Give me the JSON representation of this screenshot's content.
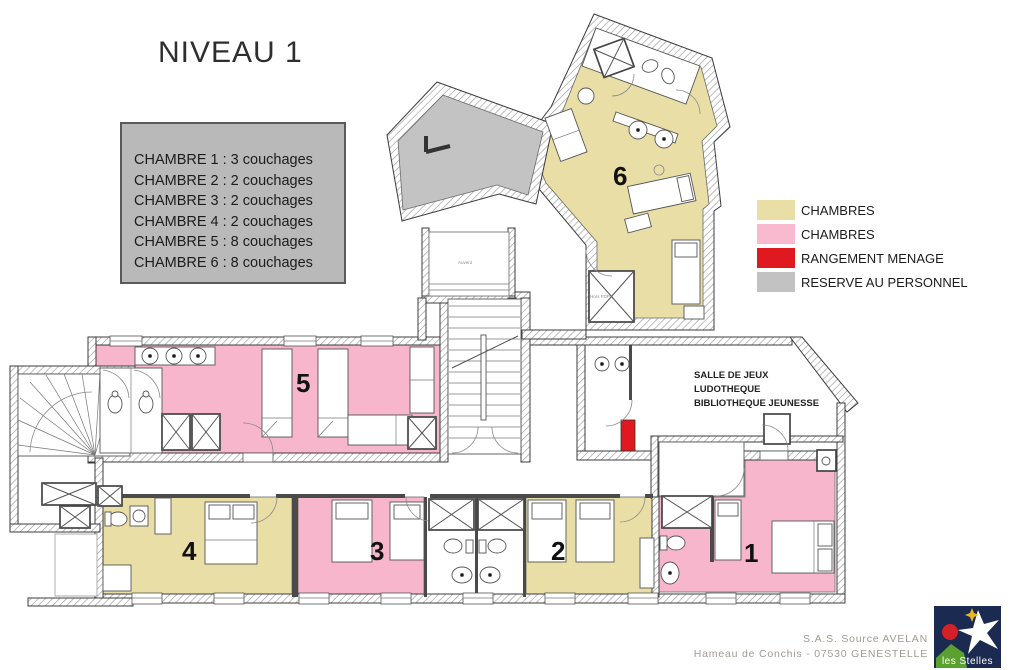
{
  "title": "NIVEAU 1",
  "info_box": {
    "lines": [
      "CHAMBRE 1 : 3 couchages",
      "CHAMBRE 2 : 2 couchages",
      "CHAMBRE 3 : 2 couchages",
      "CHAMBRE 4 : 2 couchages",
      "CHAMBRE 5 : 8 couchages",
      "CHAMBRE 6 : 8 couchages"
    ]
  },
  "legend": {
    "items": [
      {
        "label": "CHAMBRES",
        "color": "#e9dea6"
      },
      {
        "label": "CHAMBRES",
        "color": "#f9b9cf"
      },
      {
        "label": "RANGEMENT MENAGE",
        "color": "#e01820"
      },
      {
        "label": "RESERVE AU PERSONNEL",
        "color": "#c2c2c2"
      }
    ]
  },
  "plan": {
    "colors": {
      "tan": "#e9dea6",
      "pink": "#f8b6cd",
      "red": "#e01820",
      "gray": "#c3c3c3"
    },
    "rooms": [
      {
        "number": "1"
      },
      {
        "number": "2"
      },
      {
        "number": "3"
      },
      {
        "number": "4"
      },
      {
        "number": "5"
      },
      {
        "number": "6"
      }
    ],
    "labels": {
      "salle_line1": "SALLE DE JEUX",
      "salle_line2": "LUDOTHEQUE",
      "salle_line3": "BIBLIOTHEQUE JEUNESSE",
      "annex": "Auvent",
      "shaft": "Hors FDP"
    }
  },
  "footer": {
    "company": "S.A.S. Source AVELAN",
    "address": "Hameau de Conchis - 07530 GENESTELLE",
    "logo_text": "les Stelles"
  }
}
